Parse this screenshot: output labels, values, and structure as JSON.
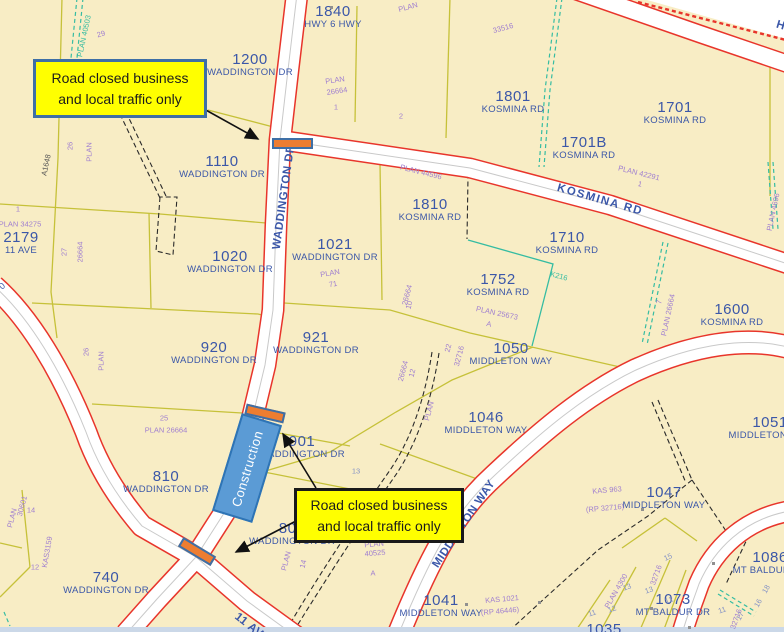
{
  "colors": {
    "parcel_fill": "#F8EDC5",
    "road_red": "#E8352B",
    "olive_line": "#C6C139",
    "teal_line": "#35BCA2",
    "label_blue": "#3B57A8",
    "plan_purple": "#A07FD0",
    "callout_yellow": "#FFFF00",
    "callout1_border": "#3E6FA6",
    "callout2_border": "#1A1A1A",
    "construction_fill": "#5B9BD5",
    "closure_orange": "#ED7D31"
  },
  "callout1": {
    "line1": "Road closed business",
    "line2": "and local traffic only"
  },
  "callout2": {
    "line1": "Road closed business",
    "line2": "and local traffic only"
  },
  "construction": {
    "label": "Construction"
  },
  "parcel_labels": [
    {
      "number": "1840",
      "street": "HWY 6 HWY",
      "x": 333,
      "y": 4
    },
    {
      "number": "1200",
      "street": "WADDINGTON DR",
      "x": 250,
      "y": 52
    },
    {
      "number": "1110",
      "street": "WADDINGTON DR",
      "x": 222,
      "y": 154
    },
    {
      "number": "1801",
      "street": "KOSMINA RD",
      "x": 513,
      "y": 89
    },
    {
      "number": "1701",
      "street": "KOSMINA RD",
      "x": 675,
      "y": 100
    },
    {
      "number": "1701B",
      "street": "KOSMINA RD",
      "x": 584,
      "y": 135
    },
    {
      "number": "2179",
      "street": "11 AVE",
      "x": 21,
      "y": 230
    },
    {
      "number": "1020",
      "street": "WADDINGTON DR",
      "x": 230,
      "y": 249
    },
    {
      "number": "1021",
      "street": "WADDINGTON DR",
      "x": 335,
      "y": 237
    },
    {
      "number": "1810",
      "street": "KOSMINA RD",
      "x": 430,
      "y": 197
    },
    {
      "number": "1710",
      "street": "KOSMINA RD",
      "x": 567,
      "y": 230
    },
    {
      "number": "1752",
      "street": "KOSMINA RD",
      "x": 498,
      "y": 272
    },
    {
      "number": "1600",
      "street": "KOSMINA RD",
      "x": 732,
      "y": 302
    },
    {
      "number": "1050",
      "street": "MIDDLETON WAY",
      "x": 511,
      "y": 341
    },
    {
      "number": "1046",
      "street": "MIDDLETON WAY",
      "x": 486,
      "y": 410
    },
    {
      "number": "1051",
      "street": "MIDDLETON WAY",
      "x": 770,
      "y": 415
    },
    {
      "number": "920",
      "street": "WADDINGTON DR",
      "x": 214,
      "y": 340
    },
    {
      "number": "921",
      "street": "WADDINGTON DR",
      "x": 316,
      "y": 330
    },
    {
      "number": "901",
      "street": "WADDINGTON DR",
      "x": 302,
      "y": 434
    },
    {
      "number": "810",
      "street": "WADDINGTON DR",
      "x": 166,
      "y": 469
    },
    {
      "number": "801",
      "street": "WADDINGTON DR",
      "x": 292,
      "y": 521
    },
    {
      "number": "740",
      "street": "WADDINGTON DR",
      "x": 106,
      "y": 570
    },
    {
      "number": "1041",
      "street": "MIDDLETON WAY",
      "x": 441,
      "y": 593
    },
    {
      "number": "1047",
      "street": "MIDDLETON WAY",
      "x": 664,
      "y": 485
    },
    {
      "number": "1086",
      "street": "MT BALDUR DR",
      "x": 770,
      "y": 550
    },
    {
      "number": "1073",
      "street": "MT BALDUR DR",
      "x": 673,
      "y": 592
    },
    {
      "number": "1035",
      "street": "",
      "x": 604,
      "y": 622
    }
  ],
  "street_labels": [
    {
      "text": "WADDINGTON DR",
      "x": 284,
      "y": 197,
      "angle": -82,
      "ls": 0.5
    },
    {
      "text": "KOSMINA RD",
      "x": 600,
      "y": 200,
      "angle": 16,
      "ls": 1.5
    },
    {
      "text": "MIDDLETON WAY",
      "x": 464,
      "y": 524,
      "angle": -56,
      "ls": 0.5
    },
    {
      "text": "11 AVE",
      "x": 252,
      "y": 628,
      "angle": 38,
      "ls": 0.5
    },
    {
      "text": "HWY 6",
      "x": 795,
      "y": 30,
      "angle": 17,
      "ls": 0.5
    }
  ],
  "small_labels": [
    {
      "text": "PLAN 40503",
      "x": 84,
      "y": 36,
      "angle": -78,
      "color": "teal"
    },
    {
      "text": "29",
      "x": 101,
      "y": 34,
      "angle": -15
    },
    {
      "text": "PLAN",
      "x": 408,
      "y": 7,
      "angle": -15
    },
    {
      "text": "33516",
      "x": 503,
      "y": 28,
      "angle": -15
    },
    {
      "text": "PLAN",
      "x": 335,
      "y": 80,
      "angle": -8
    },
    {
      "text": "26664",
      "x": 337,
      "y": 91,
      "angle": -8
    },
    {
      "text": "1",
      "x": 336,
      "y": 107,
      "angle": 0
    },
    {
      "text": "2",
      "x": 401,
      "y": 116,
      "angle": 0
    },
    {
      "text": "PLAN 42291",
      "x": 639,
      "y": 173,
      "angle": 14
    },
    {
      "text": "1",
      "x": 640,
      "y": 184,
      "angle": 14
    },
    {
      "text": "PLAN 44596",
      "x": 421,
      "y": 172,
      "angle": 14
    },
    {
      "text": "PLAN 34275",
      "x": 20,
      "y": 224,
      "angle": 0
    },
    {
      "text": "1",
      "x": 18,
      "y": 209,
      "angle": 0
    },
    {
      "text": "27",
      "x": 64,
      "y": 252,
      "angle": -90
    },
    {
      "text": "26664",
      "x": 80,
      "y": 252,
      "angle": -90
    },
    {
      "text": "PLAN",
      "x": 89,
      "y": 152,
      "angle": -90
    },
    {
      "text": "26",
      "x": 70,
      "y": 146,
      "angle": -90
    },
    {
      "text": "A1648",
      "x": 46,
      "y": 165,
      "angle": -78,
      "color": "dark"
    },
    {
      "text": "25",
      "x": 164,
      "y": 418,
      "angle": 0
    },
    {
      "text": "PLAN 26664",
      "x": 166,
      "y": 430,
      "angle": 0
    },
    {
      "text": "PLAN",
      "x": 101,
      "y": 361,
      "angle": -90
    },
    {
      "text": "26",
      "x": 86,
      "y": 352,
      "angle": -90
    },
    {
      "text": "PLAN",
      "x": 330,
      "y": 273,
      "angle": -10
    },
    {
      "text": "71",
      "x": 333,
      "y": 284,
      "angle": -10
    },
    {
      "text": "PLAN 25673",
      "x": 497,
      "y": 313,
      "angle": 12
    },
    {
      "text": "A",
      "x": 489,
      "y": 324,
      "angle": 12
    },
    {
      "text": "26664",
      "x": 407,
      "y": 295,
      "angle": -75
    },
    {
      "text": "10",
      "x": 409,
      "y": 305,
      "angle": -75
    },
    {
      "text": "K216",
      "x": 559,
      "y": 276,
      "angle": 15,
      "color": "teal"
    },
    {
      "text": "PLAN 26664",
      "x": 668,
      "y": 315,
      "angle": -78
    },
    {
      "text": "7",
      "x": 659,
      "y": 302,
      "angle": -78
    },
    {
      "text": "PLAN 4696",
      "x": 773,
      "y": 212,
      "angle": -78
    },
    {
      "text": "26664",
      "x": 403,
      "y": 371,
      "angle": -75
    },
    {
      "text": "12",
      "x": 412,
      "y": 373,
      "angle": -75
    },
    {
      "text": "22",
      "x": 448,
      "y": 348,
      "angle": -75
    },
    {
      "text": "32716",
      "x": 459,
      "y": 356,
      "angle": -75
    },
    {
      "text": "PLAN",
      "x": 429,
      "y": 411,
      "angle": -75
    },
    {
      "text": "13",
      "x": 356,
      "y": 471,
      "angle": 0,
      "color": "bluegrey"
    },
    {
      "text": "PLAN",
      "x": 286,
      "y": 561,
      "angle": -75
    },
    {
      "text": "14",
      "x": 303,
      "y": 564,
      "angle": -75
    },
    {
      "text": "PLAN",
      "x": 374,
      "y": 544,
      "angle": -5
    },
    {
      "text": "40525",
      "x": 375,
      "y": 553,
      "angle": -5
    },
    {
      "text": "A",
      "x": 373,
      "y": 573,
      "angle": 0
    },
    {
      "text": "KAS 1021",
      "x": 502,
      "y": 599,
      "angle": -5
    },
    {
      "text": "(RP 46446)",
      "x": 500,
      "y": 611,
      "angle": -5
    },
    {
      "text": "KAS 963",
      "x": 607,
      "y": 490,
      "angle": -5
    },
    {
      "text": "(RP 32716)",
      "x": 605,
      "y": 508,
      "angle": -5
    },
    {
      "text": "KAS3159",
      "x": 47,
      "y": 552,
      "angle": -80
    },
    {
      "text": "PLAN",
      "x": 12,
      "y": 518,
      "angle": -75
    },
    {
      "text": "30601",
      "x": 22,
      "y": 506,
      "angle": -75
    },
    {
      "text": "14",
      "x": 31,
      "y": 510,
      "angle": 0
    },
    {
      "text": "12",
      "x": 35,
      "y": 567,
      "angle": 0
    },
    {
      "text": "PLAN 4300",
      "x": 616,
      "y": 591,
      "angle": -60
    },
    {
      "text": "32716",
      "x": 656,
      "y": 575,
      "angle": -70
    },
    {
      "text": "32716",
      "x": 736,
      "y": 619,
      "angle": -70
    },
    {
      "text": "15",
      "x": 668,
      "y": 557,
      "angle": -25,
      "color": "bluegrey"
    },
    {
      "text": "13",
      "x": 649,
      "y": 590,
      "angle": -20,
      "color": "bluegrey"
    },
    {
      "text": "12",
      "x": 669,
      "y": 600,
      "angle": -20,
      "color": "bluegrey"
    },
    {
      "text": "11",
      "x": 722,
      "y": 610,
      "angle": -20,
      "color": "bluegrey"
    },
    {
      "text": "17",
      "x": 740,
      "y": 616,
      "angle": -60,
      "color": "bluegrey"
    },
    {
      "text": "16",
      "x": 758,
      "y": 603,
      "angle": -60,
      "color": "bluegrey"
    },
    {
      "text": "18",
      "x": 766,
      "y": 589,
      "angle": -60,
      "color": "bluegrey"
    },
    {
      "text": "13",
      "x": 627,
      "y": 587,
      "angle": -20,
      "color": "bluegrey"
    },
    {
      "text": "12",
      "x": 612,
      "y": 609,
      "angle": -20,
      "color": "bluegrey"
    },
    {
      "text": "11",
      "x": 592,
      "y": 613,
      "angle": -20,
      "color": "bluegrey"
    },
    {
      "text": "0",
      "x": 2,
      "y": 286,
      "angle": -40,
      "color": "blue"
    }
  ],
  "markers": [
    {
      "x": 330,
      "y": 6
    },
    {
      "x": 641,
      "y": 508
    },
    {
      "x": 712,
      "y": 562
    },
    {
      "x": 650,
      "y": 607
    },
    {
      "x": 465,
      "y": 603
    },
    {
      "x": 538,
      "y": 601
    },
    {
      "x": 688,
      "y": 626
    }
  ]
}
